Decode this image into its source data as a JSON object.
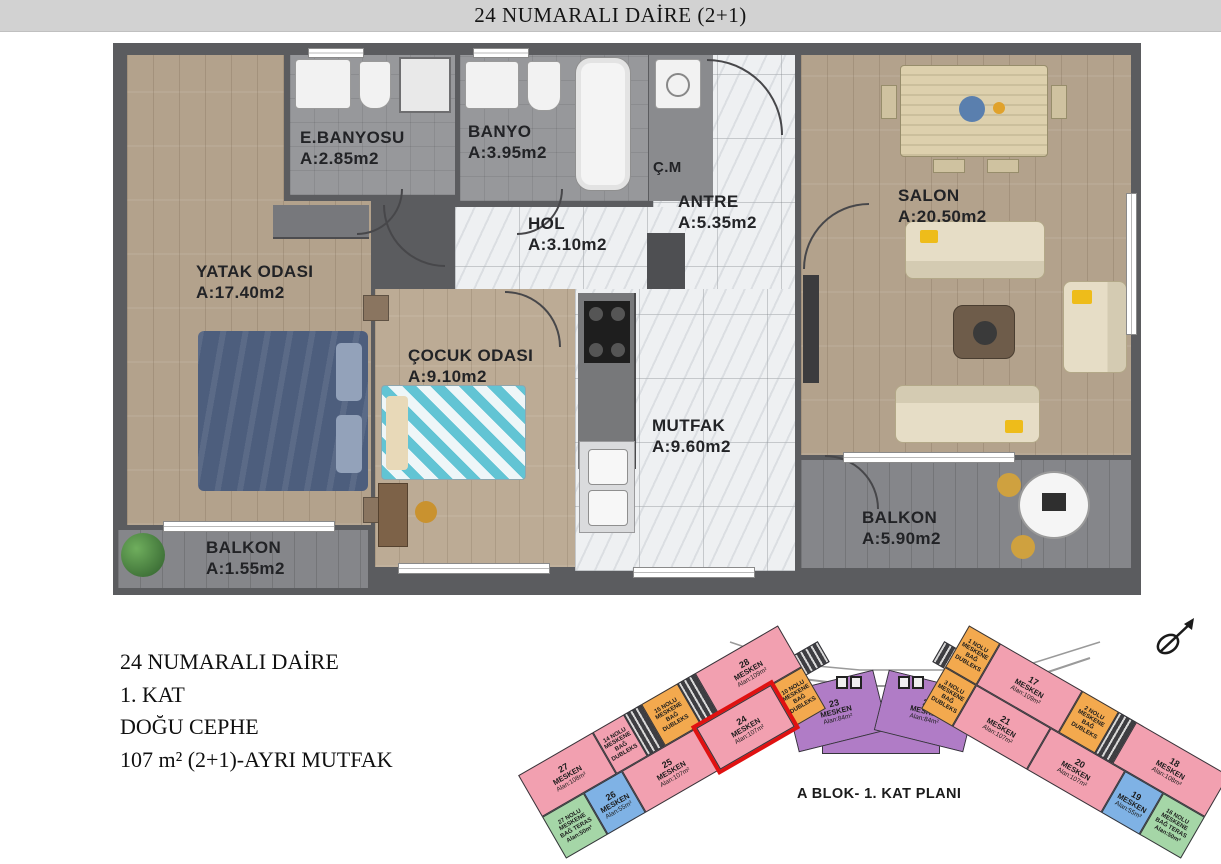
{
  "header": {
    "title": "24 NUMARALI DAİRE (2+1)"
  },
  "floor_plan": {
    "rooms": [
      {
        "name": "E.BANYOSU",
        "area": "A:2.85m2"
      },
      {
        "name": "BANYO",
        "area": "A:3.95m2"
      },
      {
        "name": "Ç.M",
        "area": ""
      },
      {
        "name": "ANTRE",
        "area": "A:5.35m2"
      },
      {
        "name": "SALON",
        "area": "A:20.50m2"
      },
      {
        "name": "HOL",
        "area": "A:3.10m2"
      },
      {
        "name": "YATAK ODASI",
        "area": "A:17.40m2"
      },
      {
        "name": "ÇOCUK ODASI",
        "area": "A:9.10m2"
      },
      {
        "name": "MUTFAK",
        "area": "A:9.60m2"
      },
      {
        "name": "BALKON",
        "area": "A:1.55m2"
      },
      {
        "name": "BALKON",
        "area": "A:5.90m2"
      }
    ]
  },
  "info_block": {
    "lines": [
      "24 NUMARALI DAİRE",
      "1. KAT",
      "DOĞU CEPHE",
      "107 m² (2+1)-AYRI MUTFAK"
    ]
  },
  "site_plan": {
    "caption": "A BLOK- 1. KAT PLANI",
    "units": [
      {
        "number": "28",
        "label": "MESKEN",
        "area": "Alan:109m²"
      },
      {
        "number": "27",
        "label": "MESKEN",
        "area": "Alan:108m²"
      },
      {
        "number": "26",
        "label": "MESKEN",
        "area": "Alan:55m²"
      },
      {
        "number": "25",
        "label": "MESKEN",
        "area": "Alan:107m²"
      },
      {
        "number": "24",
        "label": "MESKEN",
        "area": "Alan:107m²",
        "highlighted": true
      },
      {
        "number": "23",
        "label": "MESKEN",
        "area": "Alan:84m²"
      },
      {
        "number": "22",
        "label": "MESKEN",
        "area": "Alan:84m²"
      },
      {
        "number": "21",
        "label": "MESKEN",
        "area": "Alan:107m²"
      },
      {
        "number": "20",
        "label": "MESKEN",
        "area": "Alan:107m²"
      },
      {
        "number": "19",
        "label": "MESKEN",
        "area": "Alan:55m²"
      },
      {
        "number": "18",
        "label": "MESKEN",
        "area": "Alan:108m²"
      },
      {
        "number": "17",
        "label": "MESKEN",
        "area": "Alan:109m²"
      }
    ],
    "annexes": [
      "15 NOLU MESKENE BAĞ DUBLEKS",
      "14 NOLU MESKENE BAĞ DUBLEKS",
      "10 NOLU MESKENE BAĞ DUBLEKS",
      "27 NOLU MESKENE BAĞ TERAS Alan:50m²",
      "1 NOLU MESKENE BAĞ DUBLEKS",
      "2 NOLU MESKENE BAĞ DUBLEKS",
      "3 NOLU MESKENE BAĞ DUBLEKS",
      "16 NOLU MESKENE BAĞ TERAS Alan:50m²"
    ],
    "legend_colors": {
      "mesken_pink": "#f2a0b0",
      "dubleks_orange": "#f3a94e",
      "teras_green": "#a5d6a7",
      "small_mesken_blue": "#7fb2e5",
      "middle_mesken_purple": "#b07cc6",
      "highlight_red": "#e01111"
    }
  }
}
